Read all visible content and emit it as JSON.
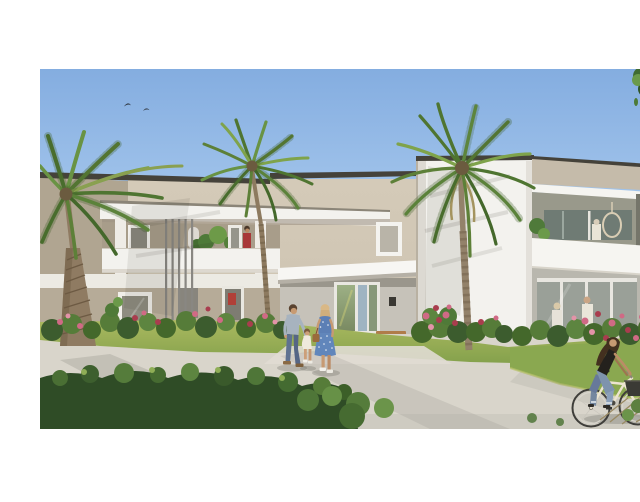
{
  "image": {
    "alt": "3D architectural rendering of a modern two-storey apartment residence with beige and white facades, flat roofs, palm trees, flowering gardens, a family walking on a gravel path and a woman riding a bicycle",
    "type": "real-estate rendering",
    "frame": {
      "width": 640,
      "height": 470,
      "photo_area": {
        "x": 0,
        "y": 53,
        "width": 640,
        "height": 360
      }
    }
  },
  "palette": {
    "sky-top": "#84ade0",
    "sky-mid": "#a9caee",
    "sky-horizon": "#dcebf6",
    "facade-beige": "#cdc3b1",
    "facade-beige-shade": "#b0a591",
    "facade-white": "#f3f2ee",
    "roof-edge": "#45423a",
    "loggia-shade": "#a89d8a",
    "glass-dark": "#8a887e",
    "glass-green": "#7a8a62",
    "lawn-green": "#9bb257",
    "path-gravel": "#d9d5cb",
    "foliage-dark": "#3c5c2e",
    "foliage-mid": "#567c39",
    "foliage-light": "#7da14a",
    "palm-green": "#5d8038",
    "palm-trunk": "#8f7b62",
    "flower-pink": "#d06a85",
    "flower-crimson": "#a93d4e",
    "wood-bench": "#b07c4a",
    "denim-blue": "#5f7291",
    "dress-blue": "#5c7fb5",
    "skin": "#c79a72",
    "bush-foreground": "#2f4c26"
  },
  "labels": {
    "photo": "residence exterior rendering",
    "sky": "clear blue sky",
    "birds": "two birds flying",
    "street_tree": "tree canopy overhanging top right corner",
    "left_wing": "beige two-storey wing with white canopy, vertical louvers and planted balconies",
    "entrance_tower": "white stairwell tower with glazed entrance lobby",
    "right_wing": "right wing with roof fascia, terrace with hanging chair and glazed ground floor",
    "entrance_door": "glazed entrance doors",
    "bench": "wooden bench by the entrance",
    "wall_lamp": "entrance wall lamp",
    "garden_wall": "low white garden wall",
    "lawn": "lawn",
    "path": "light gravel pathway",
    "palm_left": "palm tree at left edge",
    "palm_center": "slender palm tree centre left",
    "palm_large": "large palm tree in front of the white tower",
    "flower_beds": "flower beds with pink and crimson blooms",
    "balcony_resident": "resident in red on the balcony",
    "terrace_residents": "residents behind the ground floor glazing",
    "walking_man": "man in grey-blue t-shirt and jeans walking with a child",
    "walking_child": "toddler in white",
    "walking_woman": "woman in a blue floral dress with a handbag",
    "cyclist": "woman in black top and jeans riding a cream bicycle with a front basket",
    "foreground_bushes": "dark green foreground shrubs"
  },
  "scene": {
    "sky": {
      "birds": 2
    },
    "buildings": {
      "left_wing": "beige block, flat dark roof edge, white canopy slab, grey vertical louvers, white parapet balcony with plants",
      "entrance_tower": "tall white volume with small framed window beside it, porch canopy, reflective glass doors, bench and lamp",
      "right_wing": "beige fascia over white slab, recessed terrace with hanging rattan chair and white columns, glazed lounge below"
    },
    "vegetation": {
      "palm_trees": 3,
      "flower_beds": 4,
      "street_tree": 1
    },
    "people": [
      {
        "name": "man walking with child",
        "clothing": "grey-blue t-shirt, jeans, tan shoes"
      },
      {
        "name": "toddler",
        "clothing": "white outfit"
      },
      {
        "name": "woman walking",
        "clothing": "blue floral dress, brown handbag, white sneakers"
      },
      {
        "name": "woman cycling",
        "clothing": "black tank top, jeans",
        "bicycle": "cream city bike, dark front basket"
      },
      {
        "name": "resident on balcony",
        "clothing": "red"
      },
      {
        "name": "two residents behind ground-floor glazing",
        "clothing": "white"
      }
    ]
  }
}
